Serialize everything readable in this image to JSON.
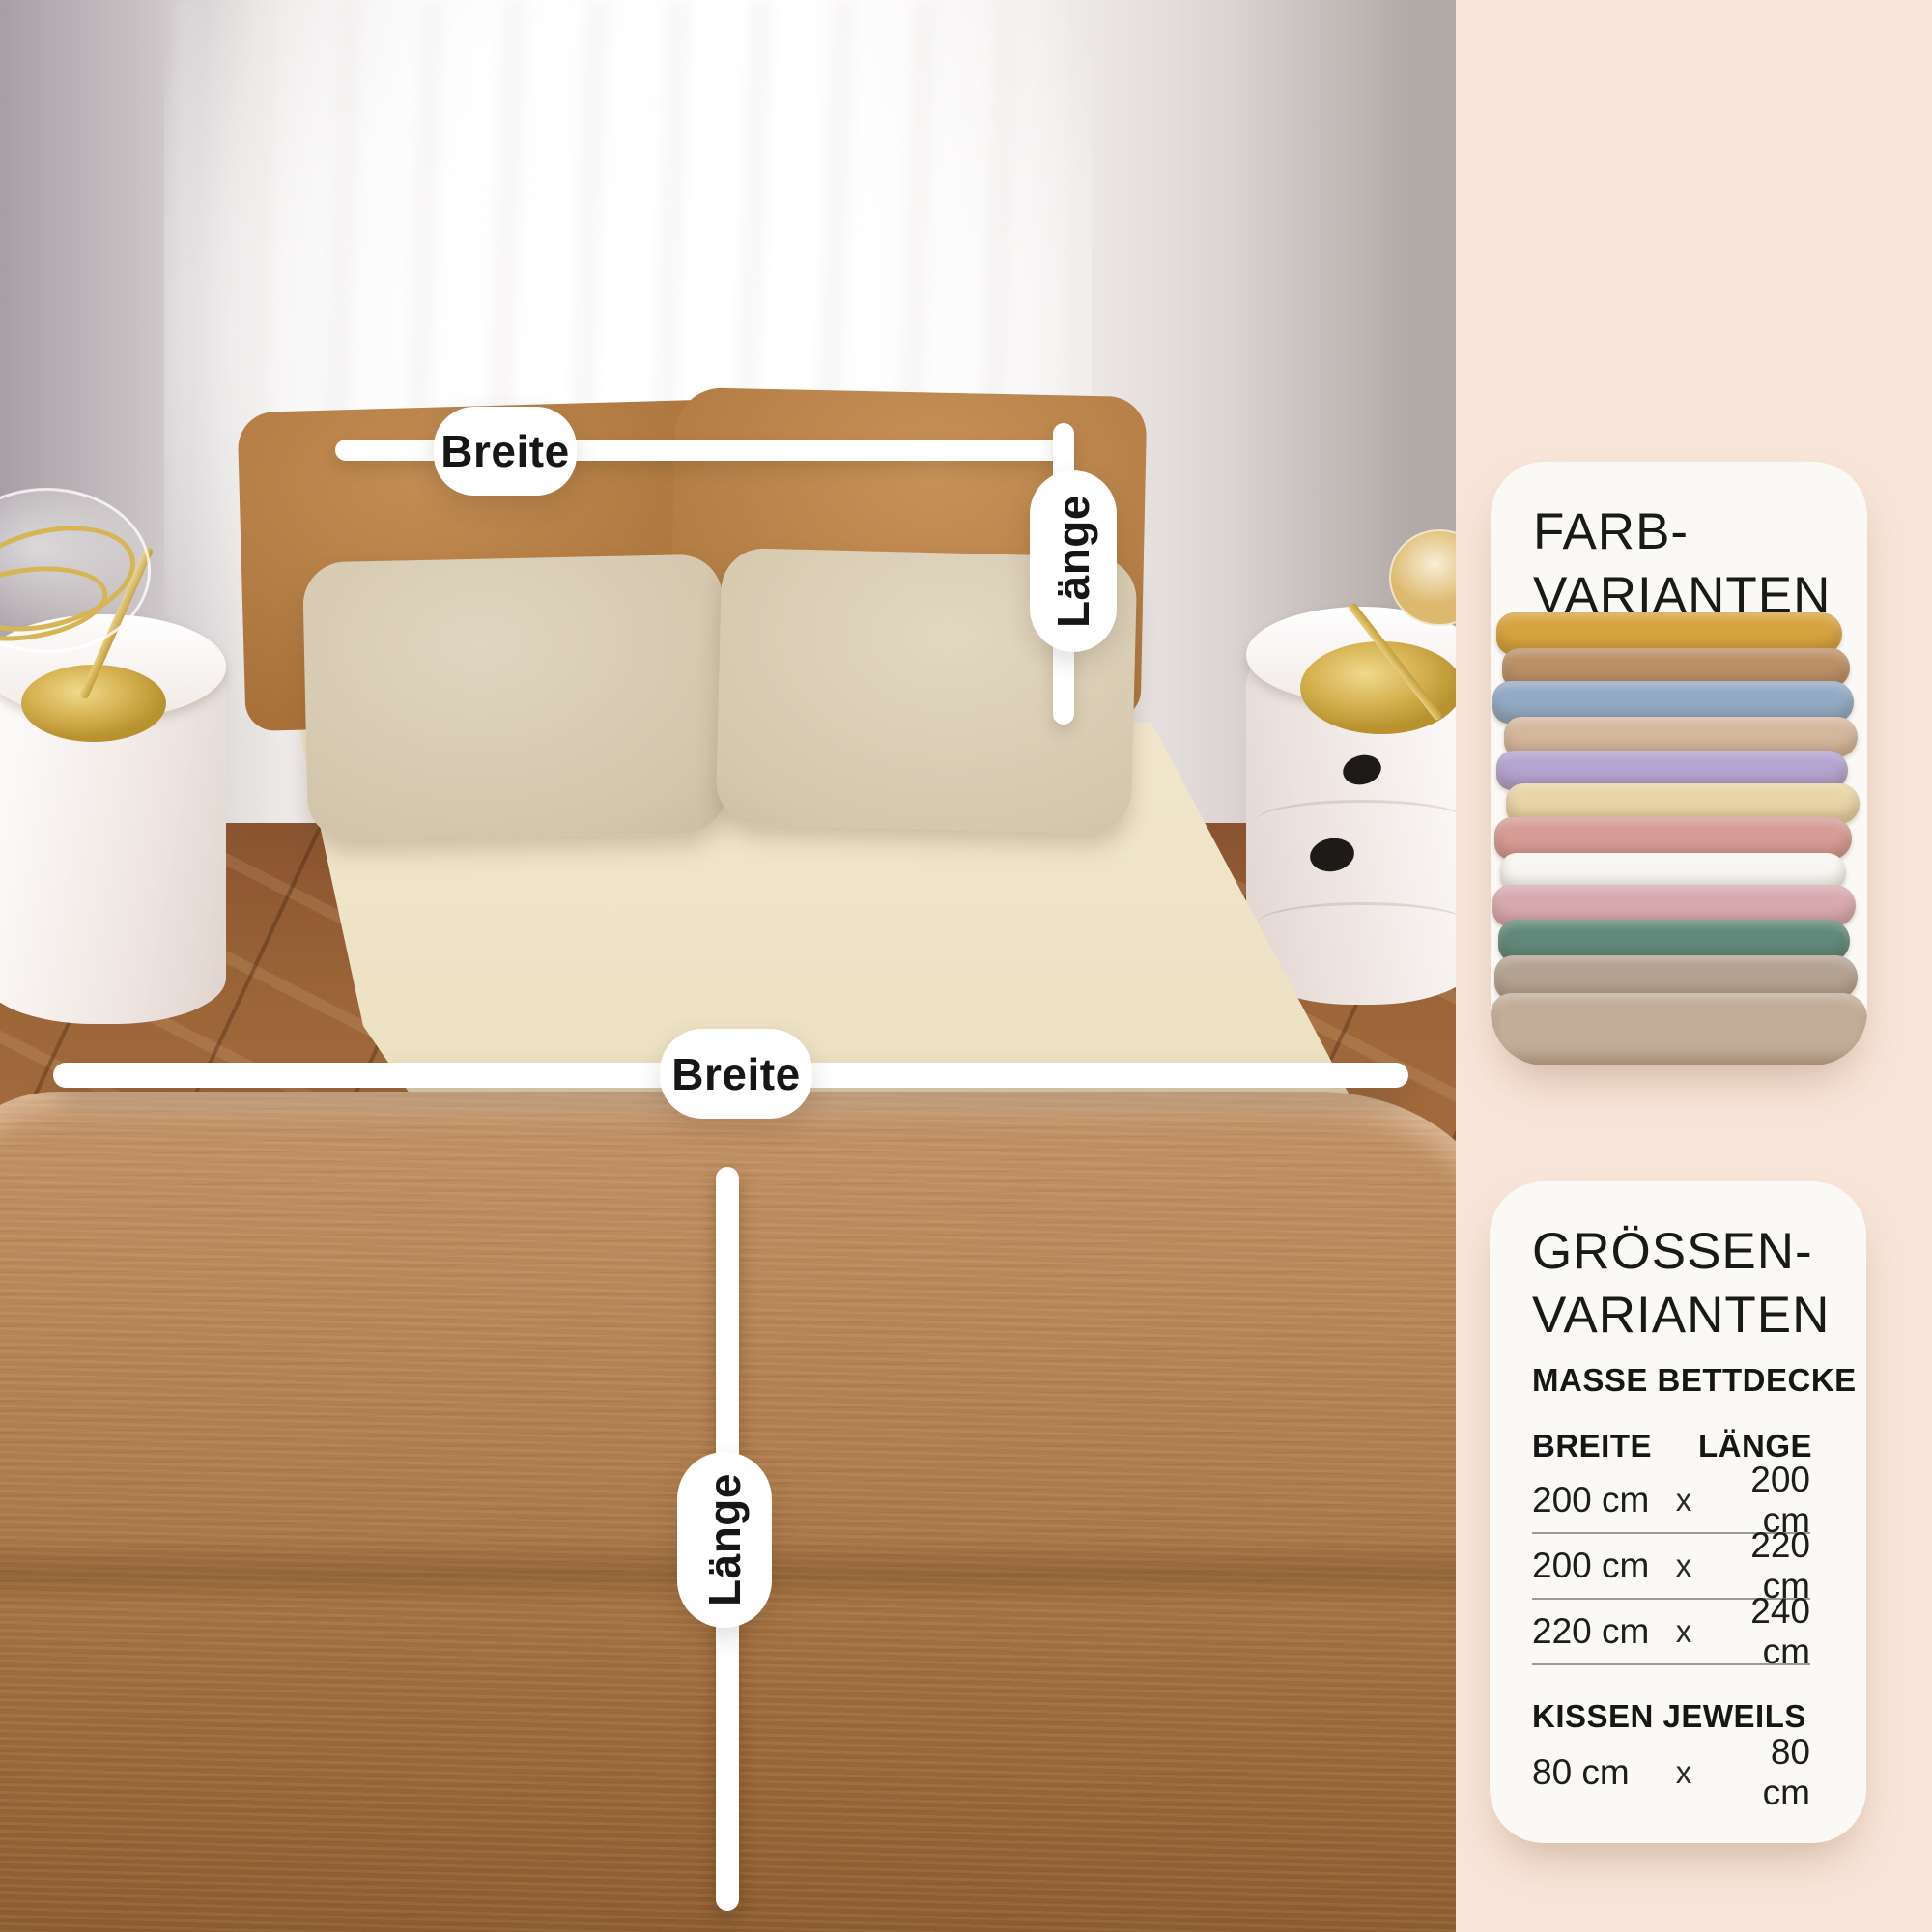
{
  "theme": {
    "sidebar_background": "#f8e5d9",
    "card_background": "#fbf9f5",
    "text_color": "#191919",
    "annotation_pill_color": "#ffffff",
    "duvet_color": "#ad7c4d",
    "sheet_color": "#f3e9cf"
  },
  "photo": {
    "annotations": {
      "pillow_width": {
        "label": "Breite"
      },
      "pillow_length": {
        "label": "Länge"
      },
      "duvet_width": {
        "label": "Breite"
      },
      "duvet_length": {
        "label": "Länge"
      }
    }
  },
  "color_card": {
    "title_line1": "FARB-",
    "title_line2": "VARIANTEN",
    "fabrics": [
      {
        "name": "mustard",
        "color": "#d6a33f"
      },
      {
        "name": "camel",
        "color": "#bb9067"
      },
      {
        "name": "steel-blue",
        "color": "#92aac5"
      },
      {
        "name": "beige",
        "color": "#d5b79e"
      },
      {
        "name": "lavender",
        "color": "#b4a4d0"
      },
      {
        "name": "vanilla",
        "color": "#e8d4a7"
      },
      {
        "name": "dusty-rose",
        "color": "#d69c95"
      },
      {
        "name": "white",
        "color": "#f8f6f2"
      },
      {
        "name": "rose",
        "color": "#d8aab0"
      },
      {
        "name": "sage-green",
        "color": "#61897b"
      },
      {
        "name": "taupe",
        "color": "#b4a392"
      },
      {
        "name": "sand",
        "color": "#c2ad98"
      }
    ]
  },
  "size_card": {
    "title_line1": "GRÖSSEN-",
    "title_line2": "VARIANTEN",
    "subtitle": "MASSE BETTDECKE",
    "columns": {
      "width": "BREITE",
      "length": "LÄNGE"
    },
    "rows": [
      {
        "width": "200 cm",
        "sep": "x",
        "length": "200 cm"
      },
      {
        "width": "200 cm",
        "sep": "x",
        "length": "220 cm"
      },
      {
        "width": "220 cm",
        "sep": "x",
        "length": "240 cm"
      }
    ],
    "pillow_heading": "KISSEN JEWEILS",
    "pillow_row": {
      "width": "80 cm",
      "sep": "x",
      "length": "80 cm"
    }
  }
}
